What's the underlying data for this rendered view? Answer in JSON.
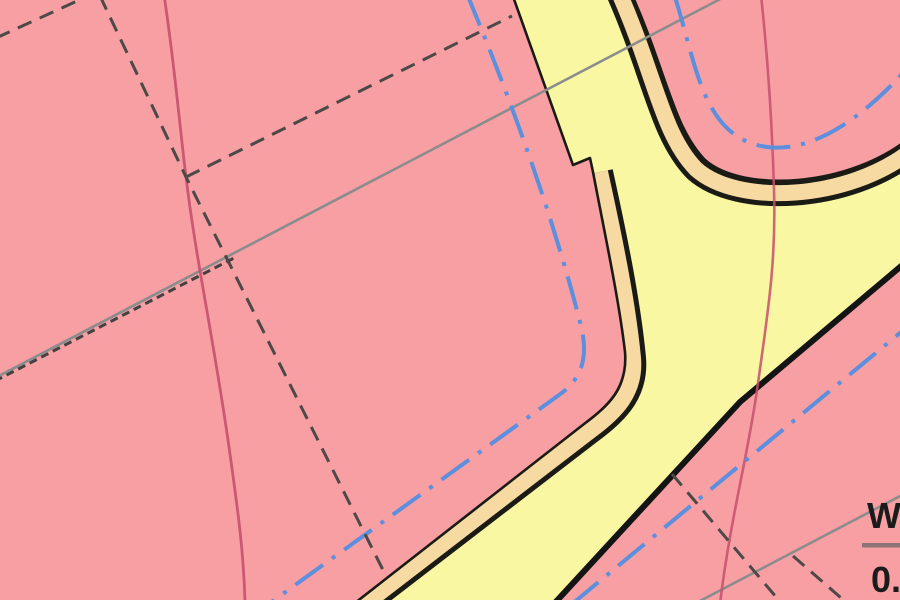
{
  "map": {
    "kind": "zoning-plan-map",
    "zoning_label": {
      "numerator": "W",
      "denominator": "0."
    },
    "colors": {
      "zone_pink": "#f89fa4",
      "road_yellow": "#f9f7a2",
      "sidewalk_tan": "#f7d9a2",
      "boundary_dark": "#1b1b16",
      "thick_boundary_dark": "#141414",
      "utility_blue": "#5c8fdd",
      "contour_crimson": "#c4506b",
      "survey_gray": "#8c8c8c",
      "parcel_dash_gray": "#4d4947",
      "braid_dash_dark": "#454140",
      "ratio_bar": "#8f7478",
      "ratio_text": "#1b1b1b"
    }
  }
}
